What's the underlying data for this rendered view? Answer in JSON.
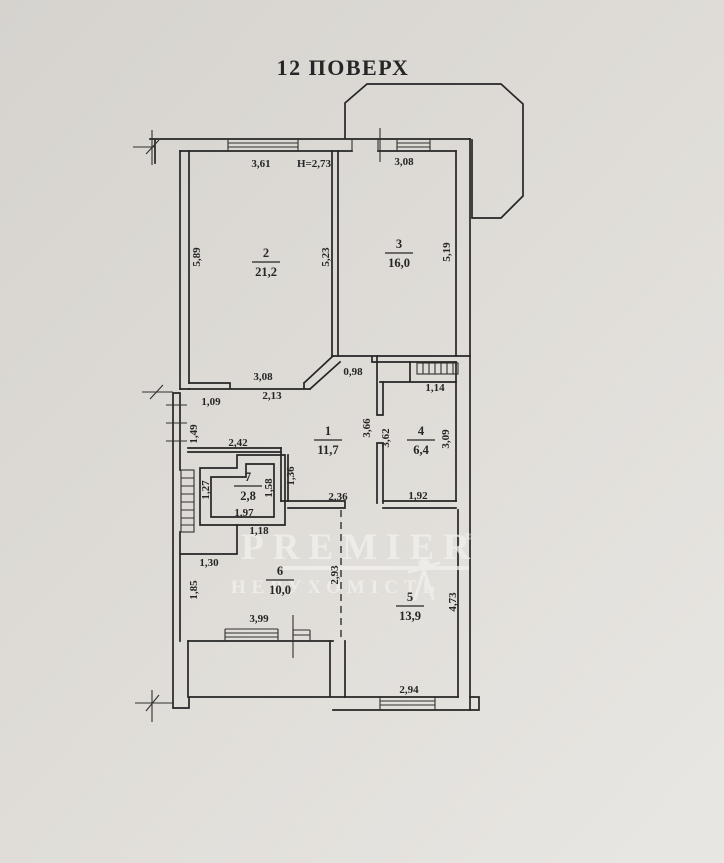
{
  "plan": {
    "title": "12 ПОВЕРХ"
  },
  "colors": {
    "paper": "#dcd9d4",
    "paper_light": "#e7e5e1",
    "ink": "#262626",
    "watermark": "#f3f2ee"
  },
  "watermark": {
    "brand": "PREMIER",
    "registered": "®",
    "subtitle": "НЕРУХОМІСТЬ"
  },
  "floorplan": {
    "rooms": [
      {
        "number": "2",
        "area": "21,2",
        "x": 266,
        "y": 257
      },
      {
        "number": "3",
        "area": "16,0",
        "x": 399,
        "y": 248
      },
      {
        "number": "1",
        "area": "11,7",
        "x": 328,
        "y": 435
      },
      {
        "number": "4",
        "area": "6,4",
        "x": 421,
        "y": 435
      },
      {
        "number": "7",
        "area": "2,8",
        "x": 248,
        "y": 481
      },
      {
        "number": "6",
        "area": "10,0",
        "x": 280,
        "y": 575
      },
      {
        "number": "5",
        "area": "13,9",
        "x": 410,
        "y": 601
      }
    ],
    "dimensions": [
      {
        "text": "3,61",
        "x": 261,
        "y": 167,
        "rot": 0
      },
      {
        "text": "Н=2,73",
        "x": 314,
        "y": 167,
        "rot": 0
      },
      {
        "text": "3,08",
        "x": 404,
        "y": 165,
        "rot": 0
      },
      {
        "text": "5,89",
        "x": 200,
        "y": 257,
        "rot": -90
      },
      {
        "text": "5,23",
        "x": 329,
        "y": 257,
        "rot": -90
      },
      {
        "text": "5,19",
        "x": 450,
        "y": 252,
        "rot": -90
      },
      {
        "text": "3,08",
        "x": 263,
        "y": 380,
        "rot": 0
      },
      {
        "text": "2,13",
        "x": 272,
        "y": 399,
        "rot": 0
      },
      {
        "text": "0,98",
        "x": 353,
        "y": 375,
        "rot": 0
      },
      {
        "text": "1,09",
        "x": 211,
        "y": 405,
        "rot": 0
      },
      {
        "text": "1,49",
        "x": 197,
        "y": 434,
        "rot": -90
      },
      {
        "text": "1,14",
        "x": 435,
        "y": 391,
        "rot": 0
      },
      {
        "text": "2,42",
        "x": 238,
        "y": 446,
        "rot": 0
      },
      {
        "text": "3,66",
        "x": 370,
        "y": 428,
        "rot": -90
      },
      {
        "text": "3,62",
        "x": 389,
        "y": 438,
        "rot": -90
      },
      {
        "text": "3,09",
        "x": 449,
        "y": 439,
        "rot": -90
      },
      {
        "text": "1,36",
        "x": 294,
        "y": 476,
        "rot": -90
      },
      {
        "text": "1,27",
        "x": 209,
        "y": 490,
        "rot": -90
      },
      {
        "text": "1,58",
        "x": 272,
        "y": 488,
        "rot": -90
      },
      {
        "text": "1,97",
        "x": 244,
        "y": 516,
        "rot": 0
      },
      {
        "text": "2,36",
        "x": 338,
        "y": 500,
        "rot": 0
      },
      {
        "text": "1,92",
        "x": 418,
        "y": 499,
        "rot": 0
      },
      {
        "text": "1,18",
        "x": 259,
        "y": 534,
        "rot": 0
      },
      {
        "text": "1,30",
        "x": 209,
        "y": 566,
        "rot": 0
      },
      {
        "text": "1,85",
        "x": 197,
        "y": 590,
        "rot": -90
      },
      {
        "text": "2,93",
        "x": 338,
        "y": 575,
        "rot": -90
      },
      {
        "text": "4,73",
        "x": 456,
        "y": 602,
        "rot": -90
      },
      {
        "text": "3,99",
        "x": 259,
        "y": 622,
        "rot": 0
      },
      {
        "text": "2,94",
        "x": 409,
        "y": 693,
        "rot": 0
      }
    ]
  }
}
